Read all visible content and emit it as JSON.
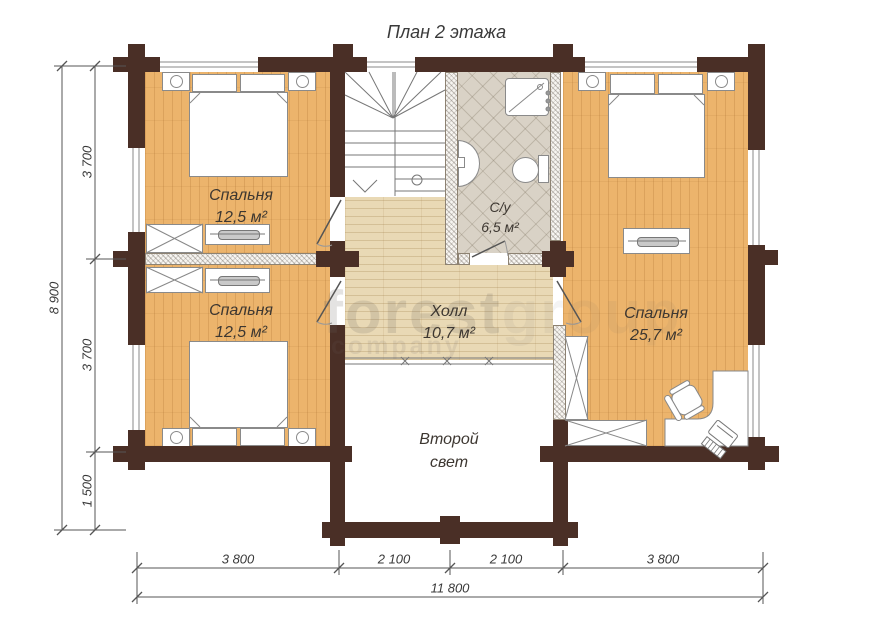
{
  "title": "План 2 этажа",
  "rooms": {
    "bedroom_top_left": {
      "label": "Спальня",
      "area": "12,5 м²"
    },
    "bedroom_bottom_left": {
      "label": "Спальня",
      "area": "12,5 м²"
    },
    "bedroom_right": {
      "label": "Спальня",
      "area": "25,7 м²"
    },
    "bathroom": {
      "label": "С/у",
      "area": "6,5 м²"
    },
    "hall": {
      "label": "Холл",
      "area": "10,7 м²"
    },
    "double_height": {
      "line1": "Второй",
      "line2": "свет"
    }
  },
  "dimensions": {
    "left": {
      "segments": [
        "3 700",
        "3 700",
        "1 500"
      ],
      "total": "8 900"
    },
    "bottom": {
      "segments": [
        "3 800",
        "2 100",
        "2 100",
        "3 800"
      ],
      "total": "11 800"
    }
  },
  "watermark": {
    "word1": "forest",
    "word2": "group",
    "word3": "company"
  },
  "colors": {
    "wall": "#4a2f26",
    "floor_warm": "#ecb46c",
    "floor_light": "#e9d9b5",
    "tile": "#d9d2c6",
    "dimension_line": "#555555"
  }
}
